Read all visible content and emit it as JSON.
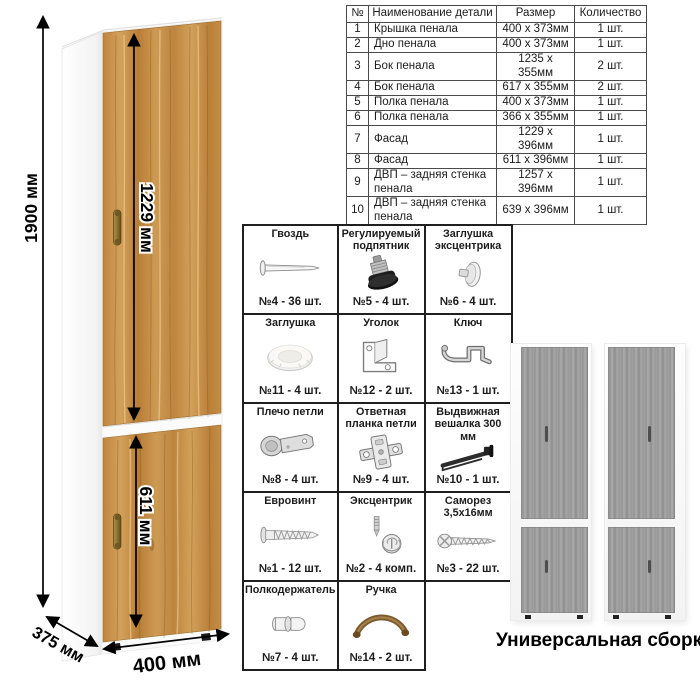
{
  "cabinet_diagram": {
    "height_label": "1900 мм",
    "upper_door_label": "1229 мм",
    "lower_door_label": "611 мм",
    "depth_label": "375 мм",
    "width_label": "400 мм",
    "wood_color": "#c4904a",
    "carcass_color": "#ffffff",
    "handle_color": "#8a6d35"
  },
  "parts_table": {
    "headers": [
      "№",
      "Наименование детали",
      "Размер",
      "Количество"
    ],
    "rows": [
      {
        "num": "1",
        "name": "Крышка пенала",
        "size": "400 x 373мм",
        "qty": "1 шт."
      },
      {
        "num": "2",
        "name": "Дно пенала",
        "size": "400 x 373мм",
        "qty": "1 шт."
      },
      {
        "num": "3",
        "name": "Бок пенала",
        "size": "1235 x 355мм",
        "qty": "2 шт."
      },
      {
        "num": "4",
        "name": "Бок пенала",
        "size": "617 x 355мм",
        "qty": "2 шт."
      },
      {
        "num": "5",
        "name": "Полка пенала",
        "size": "400 x 373мм",
        "qty": "1 шт."
      },
      {
        "num": "6",
        "name": "Полка пенала",
        "size": "366 x 355мм",
        "qty": "1 шт."
      },
      {
        "num": "7",
        "name": "Фасад",
        "size": "1229 x 396мм",
        "qty": "1 шт."
      },
      {
        "num": "8",
        "name": "Фасад",
        "size": "611 x 396мм",
        "qty": "1 шт."
      },
      {
        "num": "9",
        "name": "ДВП – задняя стенка пенала",
        "size": "1257 x 396мм",
        "qty": "1 шт."
      },
      {
        "num": "10",
        "name": "ДВП – задняя стенка пенала",
        "size": "639 x 396мм",
        "qty": "1 шт."
      }
    ]
  },
  "hardware_grid": {
    "items": [
      {
        "label": "Гвоздь",
        "count": "№4 - 36 шт.",
        "icon": "nail-icon"
      },
      {
        "label": "Регулируемый подпятник",
        "count": "№5 - 4 шт.",
        "icon": "adjustable-foot-icon"
      },
      {
        "label": "Заглушка эксцентрика",
        "count": "№6 - 4 шт.",
        "icon": "cam-cover-icon"
      },
      {
        "label": "Заглушка",
        "count": "№11 - 4 шт.",
        "icon": "cap-icon"
      },
      {
        "label": "Уголок",
        "count": "№12 - 2 шт.",
        "icon": "corner-bracket-icon"
      },
      {
        "label": "Ключ",
        "count": "№13 - 1 шт.",
        "icon": "key-icon"
      },
      {
        "label": "Плечо петли",
        "count": "№8 - 4 шт.",
        "icon": "hinge-arm-icon"
      },
      {
        "label": "Ответная планка петли",
        "count": "№9 - 4 шт.",
        "icon": "hinge-plate-icon"
      },
      {
        "label": "Выдвижная вешалка 300 мм",
        "count": "№10 - 1 шт.",
        "icon": "pullout-hanger-icon"
      },
      {
        "label": "Евровинт",
        "count": "№1 - 12 шт.",
        "icon": "euro-screw-icon"
      },
      {
        "label": "Эксцентрик",
        "count": "№2 - 4 комп.",
        "icon": "cam-lock-icon"
      },
      {
        "label": "Саморез 3,5x16мм",
        "count": "№3 - 22 шт.",
        "icon": "self-tapping-screw-icon"
      },
      {
        "label": "Полкодержатель",
        "count": "№7 - 4 шт.",
        "icon": "shelf-pin-icon"
      },
      {
        "label": "Ручка",
        "count": "№14 - 2 шт.",
        "icon": "handle-icon"
      }
    ]
  },
  "assembly_preview": {
    "caption": "Универсальная сборка.",
    "gray_wood_color": "#9b9b9b"
  }
}
